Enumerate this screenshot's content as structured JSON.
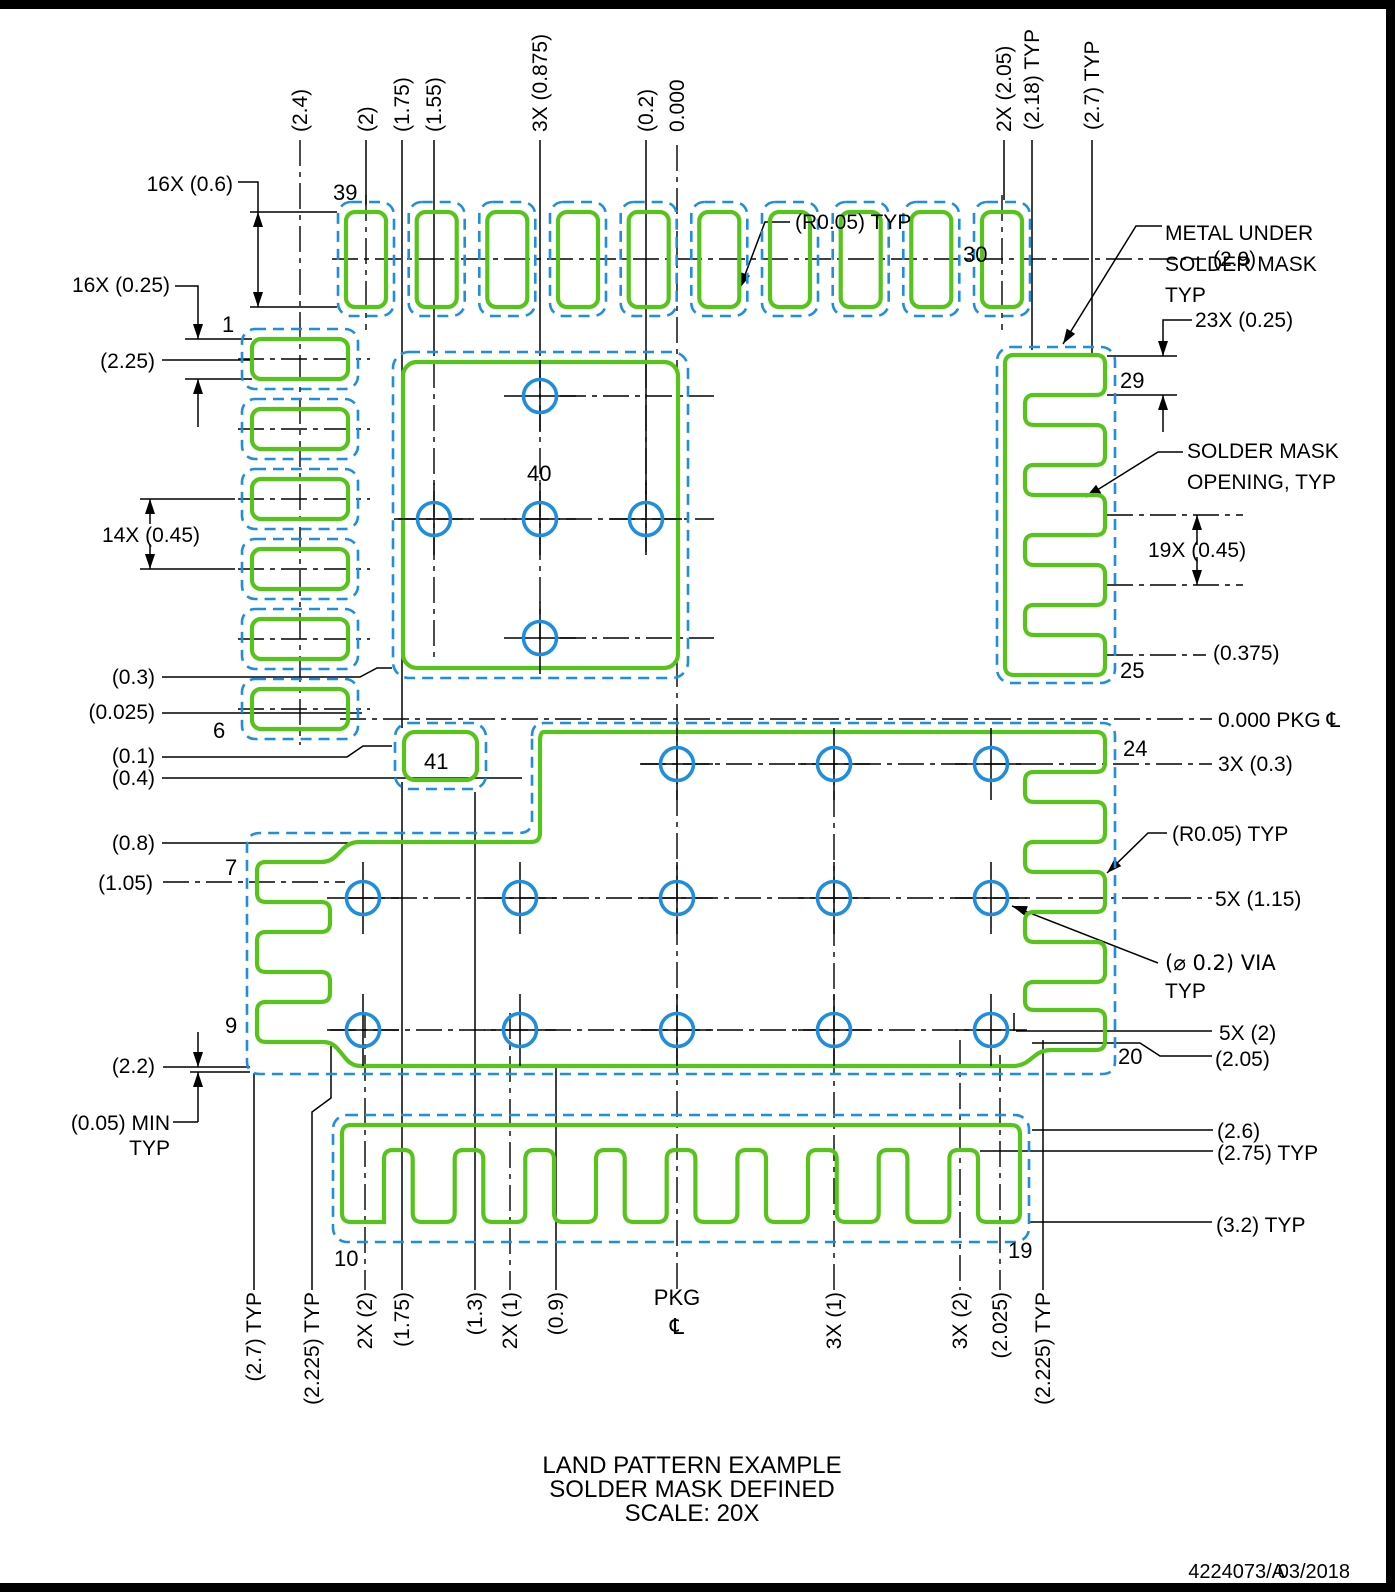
{
  "colors": {
    "copper_green": "#57c41c",
    "mask_blue": "#1f8ede",
    "frame_black": "#000000"
  },
  "top_dims": [
    "(2.4)",
    "(2)",
    "(1.75)",
    "(1.55)",
    "3X (0.875)",
    "(0.2)",
    "0.000",
    "2X (2.05)",
    "(2.18) TYP",
    "(2.7) TYP"
  ],
  "bottom_dims": [
    "(2.7) TYP",
    "(2.225) TYP",
    "2X (2)",
    "(1.75)",
    "(1.3)",
    "2X (1)",
    "(0.9)",
    "3X (1)",
    "3X (2)",
    "(2.025)",
    "(2.225) TYP"
  ],
  "left_dims": [
    "16X (0.6)",
    "16X (0.25)",
    "(2.25)",
    "14X (0.45)",
    "(0.3)",
    "(0.025)",
    "(0.1)",
    "(0.4)",
    "(0.8)",
    "(1.05)",
    "(2.2)",
    "(0.05) MIN",
    "TYP"
  ],
  "right_dims": [
    "(2.9)",
    "23X (0.25)",
    "19X (0.45)",
    "(0.375)",
    "0.000 PKG",
    "3X (0.3)",
    "(R0.05) TYP",
    "5X (1.15)",
    "5X (2)",
    "(2.05)",
    "(2.6)",
    "(2.75) TYP",
    "(3.2) TYP"
  ],
  "callouts": {
    "metal1": "METAL UNDER",
    "metal2": "SOLDER MASK",
    "metal3": "TYP",
    "smo1": "SOLDER MASK",
    "smo2": "OPENING, TYP",
    "r005_top": "(R0.05) TYP",
    "via1": "(⌀ 0.2) VIA",
    "via2": "TYP",
    "centerline_symbol": "℄"
  },
  "pad_numbers": {
    "p1": "1",
    "p6": "6",
    "p7": "7",
    "p9": "9",
    "p10": "10",
    "p19": "19",
    "p20": "20",
    "p24": "24",
    "p25": "25",
    "p29": "29",
    "p30": "30",
    "p39": "39",
    "p40": "40",
    "p41": "41"
  },
  "package_centerline": {
    "label": "PKG",
    "symbol": "℄"
  },
  "title": {
    "line1": "LAND PATTERN EXAMPLE",
    "line2": "SOLDER MASK DEFINED",
    "line3": "SCALE: 20X"
  },
  "footer": {
    "doc_number": "4224073/A",
    "date": "03/2018"
  }
}
